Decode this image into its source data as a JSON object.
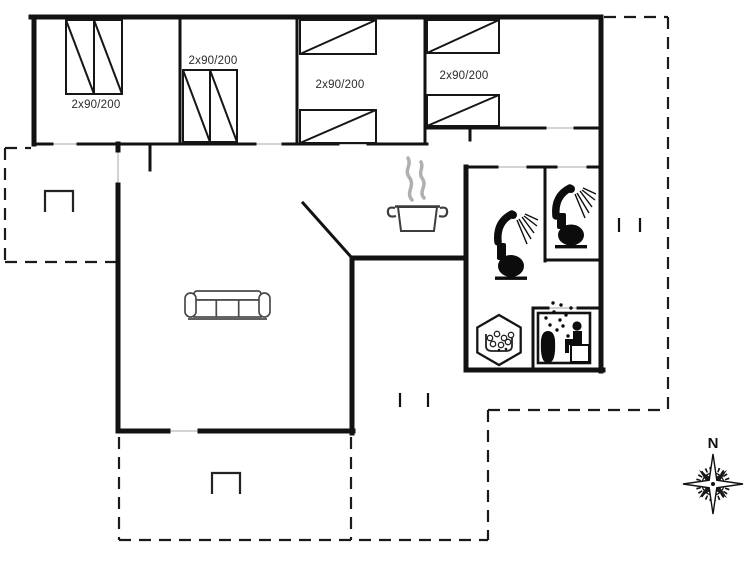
{
  "floor_plan": {
    "type": "summerhouse-floor-plan",
    "bedrooms": [
      {
        "bed_label": "2x90/200"
      },
      {
        "bed_label": "2x90/200"
      },
      {
        "bed_label": "2x90/200"
      },
      {
        "bed_label": "2x90/200"
      }
    ],
    "compass": {
      "north_label": "N"
    },
    "icons": [
      "double-bed-icon",
      "sofa-icon",
      "cooking-pot-icon",
      "shower-icon",
      "toilet-icon",
      "whirlpool-tub-icon",
      "sauna-icon",
      "compass-rose-icon"
    ],
    "colors": {
      "wall": "#121212",
      "door_marker": "#b9b9b9",
      "furniture_line": "#4a4a4a",
      "steam": "#b0b0b0",
      "background": "#ffffff"
    }
  }
}
